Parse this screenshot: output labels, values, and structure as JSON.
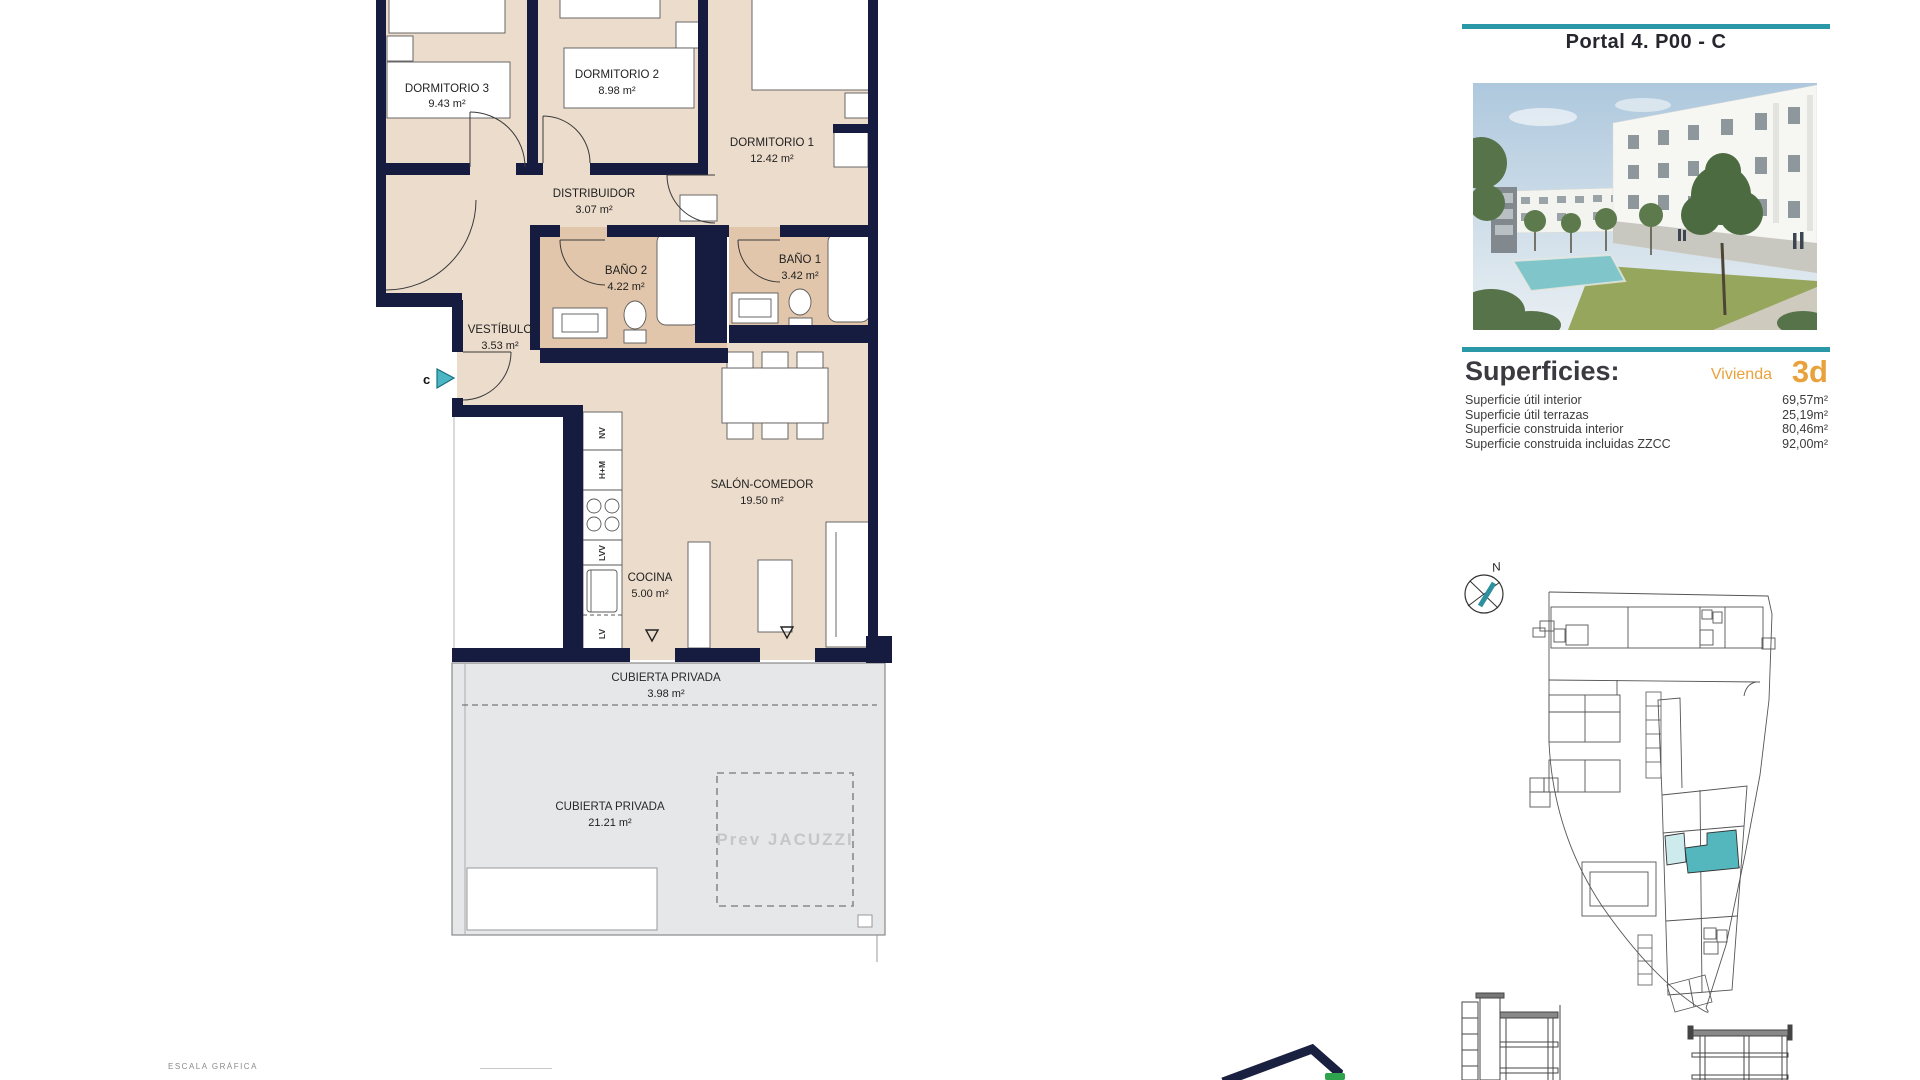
{
  "header": {
    "title": "Portal 4. P00 - C"
  },
  "superficies": {
    "heading": "Superficies:",
    "vivienda_label": "Vivienda",
    "vivienda_code": "3d",
    "rows": [
      {
        "label": "Superficie útil interior",
        "value": "69,57m²"
      },
      {
        "label": "Superficie útil terrazas",
        "value": "25,19m²"
      },
      {
        "label": "Superficie construida interior",
        "value": "80,46m²"
      },
      {
        "label": "Superficie construida incluidas ZZCC",
        "value": "92,00m²"
      }
    ]
  },
  "floorplan": {
    "rooms": [
      {
        "name": "DORMITORIO 3",
        "area": "9.43 m²"
      },
      {
        "name": "DORMITORIO 2",
        "area": "8.98 m²"
      },
      {
        "name": "DORMITORIO 1",
        "area": "12.42 m²"
      },
      {
        "name": "DISTRIBUIDOR",
        "area": "3.07 m²"
      },
      {
        "name": "BAÑO 2",
        "area": "4.22 m²"
      },
      {
        "name": "BAÑO 1",
        "area": "3.42 m²"
      },
      {
        "name": "VESTÍBULO",
        "area": "3.53 m²"
      },
      {
        "name": "SALÓN-COMEDOR",
        "area": "19.50 m²"
      },
      {
        "name": "COCINA",
        "area": "5.00 m²"
      },
      {
        "name": "CUBIERTA PRIVADA",
        "area": "3.98 m²"
      },
      {
        "name": "CUBIERTA PRIVADA",
        "area": "21.21 m²"
      }
    ],
    "jacuzzi_label": "Prev JACUZZI",
    "entrance_marker": "c",
    "kitchen_labels": [
      "NV",
      "H+M",
      "LVV",
      "LV"
    ]
  },
  "compass": {
    "north_label": "N"
  },
  "footer": {
    "scale_label": "ESCALA GRÁFICA"
  },
  "colors": {
    "teal_rule": "#2b98a7",
    "orange_accent": "#e9a23b",
    "wall_navy": "#161c3f",
    "floor_beige": "#ecdccc",
    "bath_tan": "#e2c6ab",
    "terrace_gray": "#e6e7e9",
    "site_highlight": "#53b7bd",
    "site_highlight_light": "#cdeaec",
    "badge_green": "#2fa24e"
  }
}
